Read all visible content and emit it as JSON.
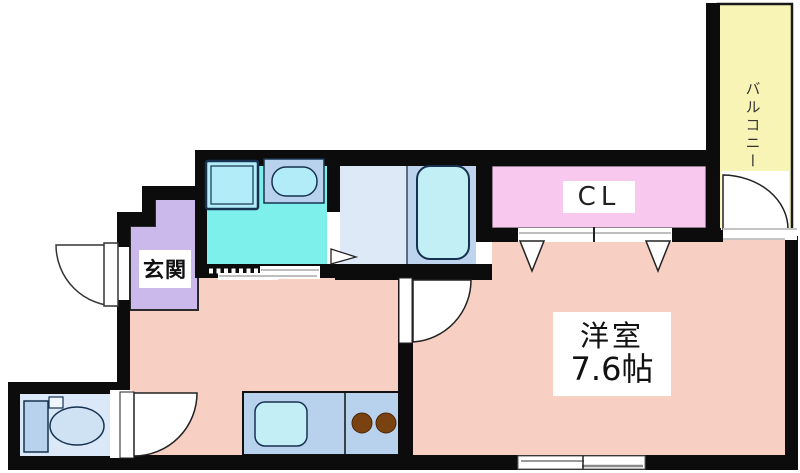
{
  "plan": {
    "rooms": {
      "entrance": {
        "label": "玄関",
        "color": "#cbb9ec"
      },
      "kitchen_dining": {
        "color": "#f7d0c3"
      },
      "western_room": {
        "label": "洋室",
        "size": "7.6帖",
        "color": "#f7d0c3"
      },
      "closet": {
        "label": "CL",
        "color": "#f8c8ef"
      },
      "balcony": {
        "label": "バルコニー",
        "color": "#f8f4b6"
      },
      "washroom": {
        "color": "#7ef0ec"
      },
      "bathroom": {
        "shower_area_color": "#dde9f7",
        "tub_area_color": "#bdd3ee"
      },
      "toilet": {
        "color": "#dbe8f8"
      }
    },
    "colors": {
      "wall": "#0c0c0c",
      "fixture_outline": "#16324f",
      "fixture_fill": "#b2ecf8",
      "tub_fill": "#c2eef6",
      "cabinet_fill": "#b8d2ee",
      "burner": "#7a4210",
      "door_fill": "#ffffff"
    }
  }
}
